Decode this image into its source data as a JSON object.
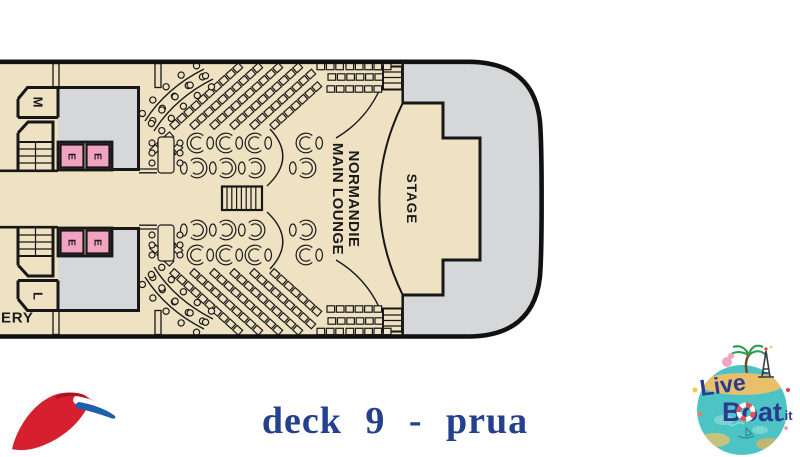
{
  "deck_plan": {
    "labels": {
      "room_top": "M",
      "room_bottom": "L",
      "elevator": "E",
      "gallery_partial": "ERY",
      "lounge_line1": "NORMANDIE",
      "lounge_line2": "MAIN LOUNGE",
      "stage": "STAGE"
    },
    "colors": {
      "deck_fill": "#EFE2C3",
      "bow_gray": "#D6D7D9",
      "lobby_gray": "#D6D7D9",
      "elevator_pink": "#F2A3C0",
      "outline": "#171717"
    }
  },
  "caption": {
    "text": "deck 9 - prua",
    "color": "#24418E"
  },
  "branding": {
    "carnival_logo": {
      "red": "#D6202F",
      "dark_red": "#A81325",
      "blue": "#1F5FAC"
    },
    "liveboat_logo": {
      "word1": "Live",
      "word2": "Boat",
      "tld": ".it",
      "navy": "#2B3990",
      "teal": "#4CC4C6"
    }
  }
}
